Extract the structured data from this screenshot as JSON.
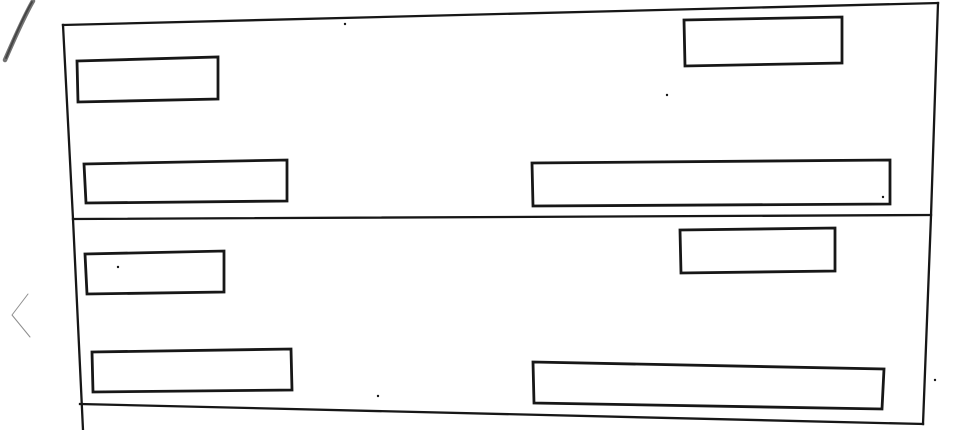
{
  "viewer": {
    "background_color": "#ffffff",
    "nav": {
      "prev_icon": "chevron-left",
      "icon_color": "#8e8e8e",
      "icon_stroke_width": 2.4
    }
  },
  "scan": {
    "ink_color": "#171717",
    "outline_stroke_width": 2.3,
    "box_stroke_width": 2.8,
    "border_lines": [
      {
        "name": "outer-border-top",
        "points": "63,25 938,3"
      },
      {
        "name": "outer-border-left",
        "points": "63,25 73,219 83,430"
      },
      {
        "name": "outer-border-right",
        "points": "938,3 931,216 923,424"
      },
      {
        "name": "outer-border-bottom",
        "points": "80,404 923,424"
      },
      {
        "name": "panel-divider-line",
        "points": "73,219 931,215"
      }
    ],
    "field_boxes": [
      {
        "name": "panel1-small-field-top-left",
        "points": "77,61 218,57 218,99 78,102"
      },
      {
        "name": "panel1-field-top-right",
        "points": "684,20 842,17 842,63 685,66"
      },
      {
        "name": "panel1-long-field-bottom-left",
        "points": "84,164 287,160 287,201 86,203"
      },
      {
        "name": "panel1-long-field-bottom-right",
        "points": "532,163 890,160 890,204 533,206"
      },
      {
        "name": "panel2-small-field-top-left",
        "points": "85,254 224,251 224,292 87,294"
      },
      {
        "name": "panel2-field-top-right",
        "points": "680,230 835,228 835,271 681,273"
      },
      {
        "name": "panel2-long-field-bottom-left",
        "points": "92,352 291,349 292,390 93,392"
      },
      {
        "name": "panel2-long-field-bottom-right",
        "points": "533,362 884,369 882,409 534,403"
      }
    ],
    "pen_strokes": [
      {
        "path": "M33,1 C26,13 15,37 5,60",
        "width": 4.5,
        "color": "#5a5a5a",
        "opacity": 0.85
      },
      {
        "path": "M32,2 C25,14 15,36 6,58",
        "width": 1.8,
        "color": "#3f3f3f",
        "opacity": 0.9
      }
    ],
    "specks": [
      [
        345,
        24
      ],
      [
        667,
        95
      ],
      [
        883,
        197
      ],
      [
        118,
        267
      ],
      [
        935,
        380
      ],
      [
        378,
        396
      ]
    ]
  }
}
